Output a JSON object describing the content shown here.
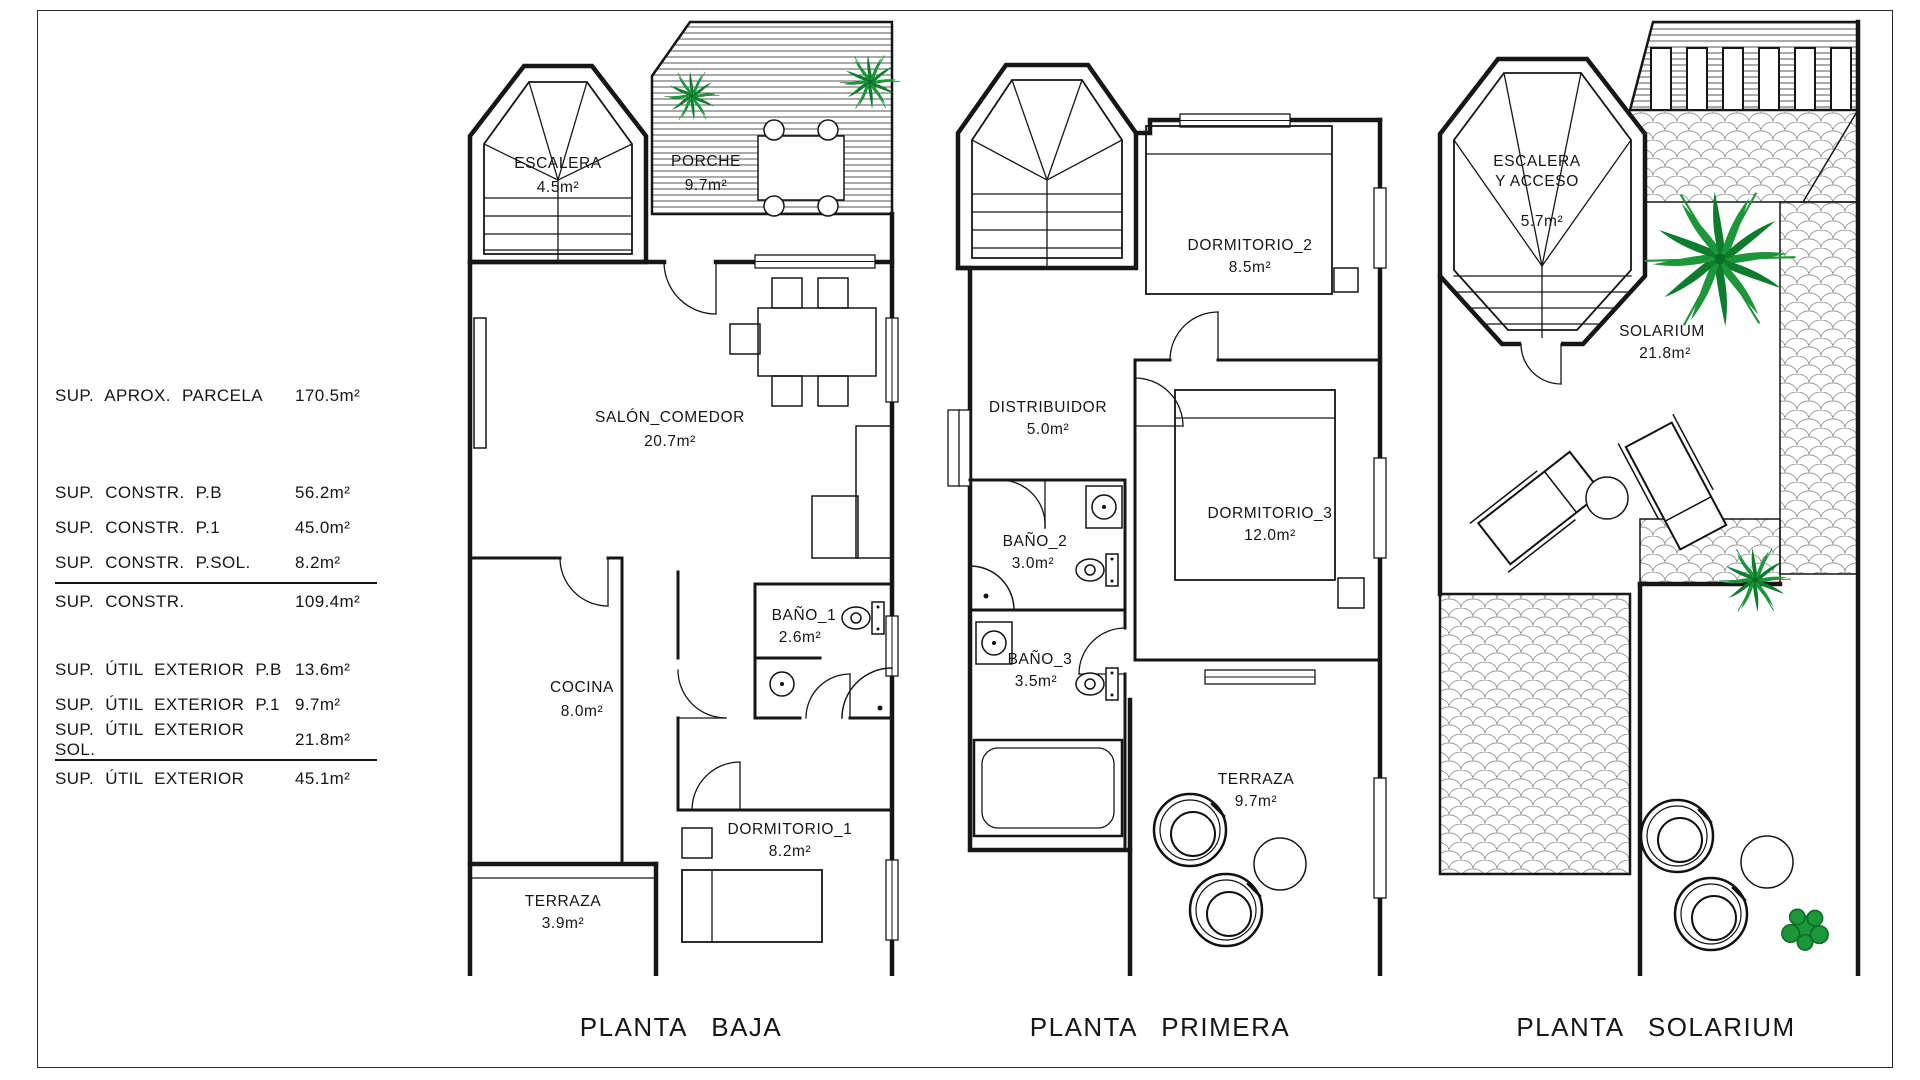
{
  "page": {
    "background": "#ffffff",
    "line_color": "#161616",
    "plant_color": "#1b9638"
  },
  "legend": {
    "rows": [
      {
        "label": "SUP. APROX. PARCELA",
        "value": "170.5m²"
      },
      {
        "label": "SUP. CONSTR. P.B",
        "value": "56.2m²"
      },
      {
        "label": "SUP. CONSTR. P.1",
        "value": "45.0m²"
      },
      {
        "label": "SUP. CONSTR. P.SOL.",
        "value": "8.2m²"
      },
      {
        "label": "SUP. CONSTR.",
        "value": "109.4m²"
      },
      {
        "label": "SUP. ÚTIL EXTERIOR P.B",
        "value": "13.6m²"
      },
      {
        "label": "SUP. ÚTIL EXTERIOR P.1",
        "value": "9.7m²"
      },
      {
        "label": "SUP. ÚTIL EXTERIOR SOL.",
        "value": "21.8m²"
      },
      {
        "label": "SUP. ÚTIL EXTERIOR",
        "value": "45.1m²"
      }
    ]
  },
  "plans": [
    {
      "title": "PLANTA BAJA",
      "rooms": {
        "escalera": {
          "name": "ESCALERA",
          "area": "4.5m²"
        },
        "porche": {
          "name": "PORCHE",
          "area": "9.7m²"
        },
        "salon": {
          "name": "SALÓN_COMEDOR",
          "area": "20.7m²"
        },
        "cocina": {
          "name": "COCINA",
          "area": "8.0m²"
        },
        "bano1": {
          "name": "BAÑO_1",
          "area": "2.6m²"
        },
        "dormitorio1": {
          "name": "DORMITORIO_1",
          "area": "8.2m²"
        },
        "terraza": {
          "name": "TERRAZA",
          "area": "3.9m²"
        }
      }
    },
    {
      "title": "PLANTA PRIMERA",
      "rooms": {
        "dormitorio2": {
          "name": "DORMITORIO_2",
          "area": "8.5m²"
        },
        "distribuidor": {
          "name": "DISTRIBUIDOR",
          "area": "5.0m²"
        },
        "bano2": {
          "name": "BAÑO_2",
          "area": "3.0m²"
        },
        "dormitorio3": {
          "name": "DORMITORIO_3",
          "area": "12.0m²"
        },
        "bano3": {
          "name": "BAÑO_3",
          "area": "3.5m²"
        },
        "terraza": {
          "name": "TERRAZA",
          "area": "9.7m²"
        }
      }
    },
    {
      "title": "PLANTA SOLARIUM",
      "rooms": {
        "escalera": {
          "name": "ESCALERA",
          "name2": "Y ACCESO",
          "area": "5.7m²"
        },
        "solarium": {
          "name": "SOLARIUM",
          "area": "21.8m²"
        }
      }
    }
  ]
}
